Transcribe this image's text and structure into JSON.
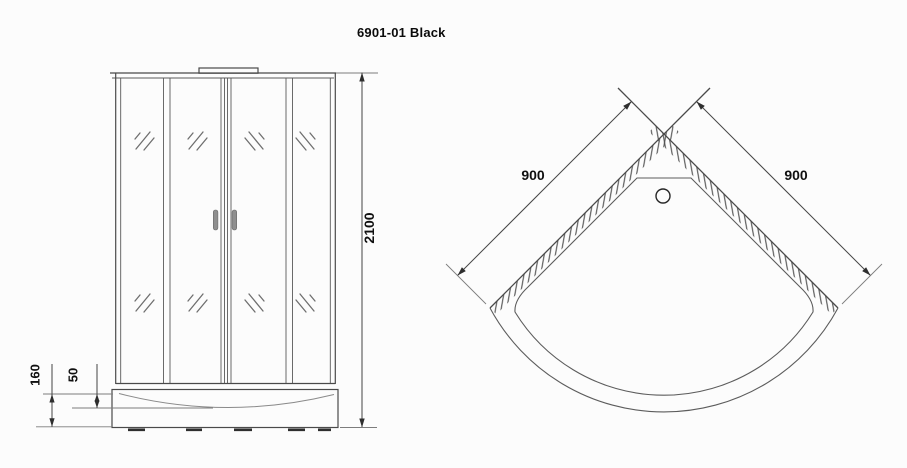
{
  "title": "6901-01 Black",
  "colors": {
    "line": "#4a4a4a",
    "handle_fill": "#8f8f8f"
  },
  "front_view": {
    "overall_height": "2100",
    "tray_height": "160",
    "tray_lip_height": "50"
  },
  "top_view": {
    "left_side_width": "900",
    "right_side_width": "900"
  }
}
